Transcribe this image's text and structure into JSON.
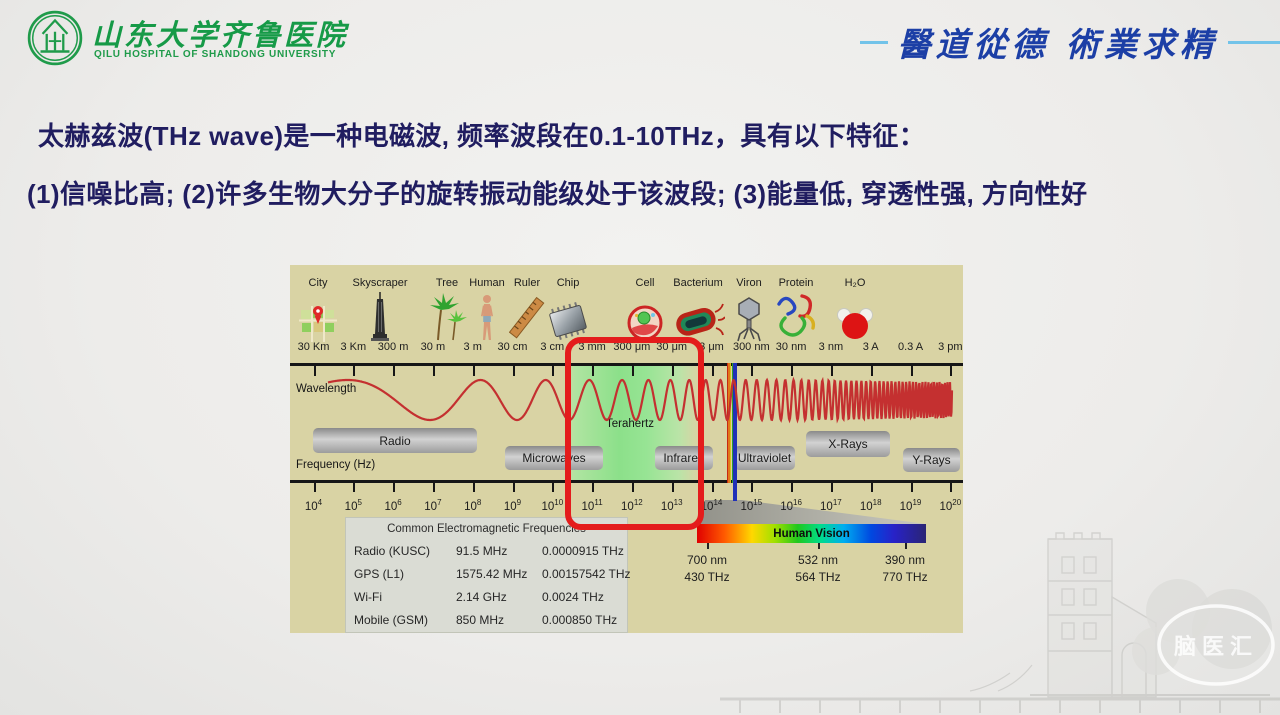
{
  "header": {
    "hospital_name_cn": "山东大学齐鲁医院",
    "hospital_name_en": "QILU HOSPITAL OF SHANDONG UNIVERSITY",
    "motto": "醫道從德  術業求精"
  },
  "intro": {
    "line1": "太赫兹波(THz wave)是一种电磁波, 频率波段在0.1-10THz，具有以下特征：",
    "line2": "(1)信噪比高; (2)许多生物大分子的旋转振动能级处于该波段; (3)能量低, 穿透性强, 方向性好"
  },
  "spectrum": {
    "objects": [
      {
        "icon": "city-icon",
        "label": "City"
      },
      {
        "icon": "skyscraper-icon",
        "label": "Skyscraper"
      },
      {
        "icon": "tree-icon",
        "label": "Tree"
      },
      {
        "icon": "human-icon",
        "label": "Human"
      },
      {
        "icon": "ruler-icon",
        "label": "Ruler"
      },
      {
        "icon": "chip-icon",
        "label": "Chip"
      },
      {
        "icon": "cell-icon",
        "label": "Cell"
      },
      {
        "icon": "bacterium-icon",
        "label": "Bacterium"
      },
      {
        "icon": "viron-icon",
        "label": "Viron"
      },
      {
        "icon": "protein-icon",
        "label": "Protein"
      },
      {
        "icon": "water-molecule-icon",
        "label": "H₂O"
      }
    ],
    "wavelengths": [
      "30 Km",
      "3 Km",
      "300 m",
      "30 m",
      "3 m",
      "30 cm",
      "3 cm",
      "3 mm",
      "300 μm",
      "30 μm",
      "3 μm",
      "300 nm",
      "30 nm",
      "3 nm",
      "3 A",
      "0.3 A",
      "3 pm"
    ],
    "freq_exponents": [
      4,
      5,
      6,
      7,
      8,
      9,
      10,
      11,
      12,
      13,
      14,
      15,
      16,
      17,
      18,
      19,
      20
    ],
    "wavelength_axis_label": "Wavelength",
    "frequency_axis_label": "Frequency (Hz)",
    "bands": [
      "Radio",
      "Microwaves",
      "Terahertz",
      "Infrared",
      "Ultraviolet",
      "X-Rays",
      "Y-Rays"
    ],
    "highlight_band": "Terahertz",
    "table": {
      "title": "Common Electromagnetic Frequencies",
      "rows": [
        [
          "Radio (KUSC)",
          "91.5 MHz",
          "0.0000915 THz"
        ],
        [
          "GPS (L1)",
          "1575.42 MHz",
          "0.00157542 THz"
        ],
        [
          "Wi-Fi",
          "2.14 GHz",
          "0.0024 THz"
        ],
        [
          "Mobile (GSM)",
          "850 MHz",
          "0.000850 THz"
        ]
      ]
    },
    "vision": {
      "label": "Human Vision",
      "marks": [
        {
          "nm": "700 nm",
          "thz": "430 THz"
        },
        {
          "nm": "532 nm",
          "thz": "564 THz"
        },
        {
          "nm": "390 nm",
          "thz": "770 THz"
        }
      ]
    }
  },
  "watermark": {
    "badge": "脑医汇"
  },
  "colors": {
    "brand_green": "#1f9b4a",
    "motto_blue": "#1c3fa6",
    "text_navy": "#201d60",
    "highlight_red": "#e41c1c",
    "diagram_bg": "#d9d3a4"
  }
}
